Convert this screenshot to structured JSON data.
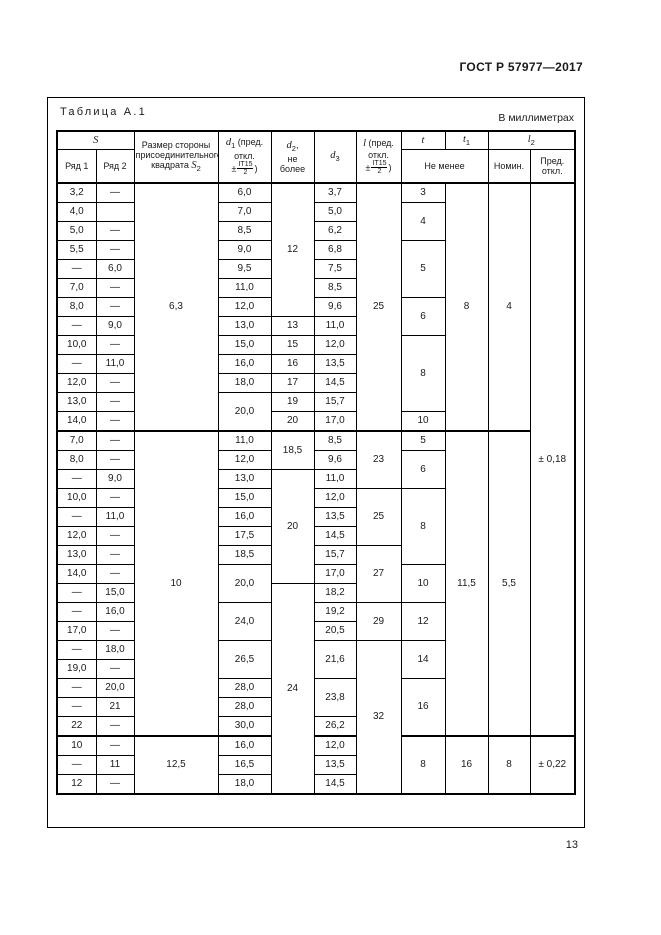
{
  "doc": {
    "standard_number": "ГОСТ Р 57977—2017",
    "page_number": "13"
  },
  "table": {
    "caption": "Таблица А.1",
    "units": "В миллиметрах",
    "header": {
      "s": "S",
      "ryad1": "Ряд 1",
      "ryad2": "Ряд 2",
      "s2": {
        "l1": "Размер стороны",
        "l2": "присоединительного",
        "l3": "квадрата",
        "var": "S",
        "sub": "2"
      },
      "d1": {
        "var": "d",
        "sub": "1",
        "t1": " (пред.",
        "t2": "откл.",
        "pm": "±",
        "num": "IT15",
        "den": "2",
        "close": ")"
      },
      "d2": {
        "var": "d",
        "sub": "2",
        "after": ",",
        "l1": "не",
        "l2": "более"
      },
      "d3": {
        "var": "d",
        "sub": "3"
      },
      "l": {
        "var": "l",
        "t1": " (пред.",
        "t2": "откл.",
        "pm": "±",
        "num": "IT15",
        "den": "2",
        "close": ")"
      },
      "t": {
        "var": "t"
      },
      "t1": {
        "var": "t",
        "sub": "1"
      },
      "l2": {
        "var": "l",
        "sub": "2"
      },
      "ne_menee": "Не менее",
      "nomin": "Номин.",
      "pred": {
        "l1": "Пред.",
        "l2": "откл."
      }
    },
    "section_start_rows": [
      13,
      29
    ],
    "rows": [
      [
        {
          "v": "3,2"
        },
        {
          "v": "—"
        },
        {
          "v": "6,3",
          "rs": 13
        },
        {
          "v": "6,0"
        },
        {
          "v": "12",
          "rs": 7
        },
        {
          "v": "3,7"
        },
        {
          "v": "25",
          "rs": 13
        },
        {
          "v": "3"
        },
        {
          "v": "8",
          "rs": 13
        },
        {
          "v": "4",
          "rs": 13
        },
        {
          "v": "± 0,18",
          "rs": 29
        }
      ],
      [
        {
          "v": "4,0"
        },
        {
          "v": ""
        },
        {
          "v": "7,0"
        },
        {
          "v": "5,0"
        },
        {
          "v": "4",
          "rs": 2
        }
      ],
      [
        {
          "v": "5,0"
        },
        {
          "v": "—"
        },
        {
          "v": "8,5"
        },
        {
          "v": "6,2"
        }
      ],
      [
        {
          "v": "5,5"
        },
        {
          "v": "—"
        },
        {
          "v": "9,0"
        },
        {
          "v": "6,8"
        },
        {
          "v": "5",
          "rs": 3
        }
      ],
      [
        {
          "v": "—"
        },
        {
          "v": "6,0"
        },
        {
          "v": "9,5"
        },
        {
          "v": "7,5"
        }
      ],
      [
        {
          "v": "7,0"
        },
        {
          "v": "—"
        },
        {
          "v": "11,0"
        },
        {
          "v": "8,5"
        }
      ],
      [
        {
          "v": "8,0"
        },
        {
          "v": "—"
        },
        {
          "v": "12,0"
        },
        {
          "v": "9,6"
        },
        {
          "v": "6",
          "rs": 2
        }
      ],
      [
        {
          "v": "—"
        },
        {
          "v": "9,0"
        },
        {
          "v": "13,0"
        },
        {
          "v": "13"
        },
        {
          "v": "11,0"
        }
      ],
      [
        {
          "v": "10,0"
        },
        {
          "v": "—"
        },
        {
          "v": "15,0"
        },
        {
          "v": "15"
        },
        {
          "v": "12,0"
        },
        {
          "v": "8",
          "rs": 4
        }
      ],
      [
        {
          "v": "—"
        },
        {
          "v": "11,0"
        },
        {
          "v": "16,0"
        },
        {
          "v": "16"
        },
        {
          "v": "13,5"
        }
      ],
      [
        {
          "v": "12,0"
        },
        {
          "v": "—"
        },
        {
          "v": "18,0"
        },
        {
          "v": "17"
        },
        {
          "v": "14,5"
        }
      ],
      [
        {
          "v": "13,0"
        },
        {
          "v": "—"
        },
        {
          "v": "20,0",
          "rs": 2
        },
        {
          "v": "19"
        },
        {
          "v": "15,7"
        }
      ],
      [
        {
          "v": "14,0"
        },
        {
          "v": "—"
        },
        {
          "v": "20"
        },
        {
          "v": "17,0"
        },
        {
          "v": "10"
        }
      ],
      [
        {
          "v": "7,0"
        },
        {
          "v": "—"
        },
        {
          "v": "10",
          "rs": 16
        },
        {
          "v": "11,0"
        },
        {
          "v": "18,5",
          "rs": 2
        },
        {
          "v": "8,5"
        },
        {
          "v": "23",
          "rs": 3
        },
        {
          "v": "5"
        },
        {
          "v": "11,5",
          "rs": 16
        },
        {
          "v": "5,5",
          "rs": 16
        }
      ],
      [
        {
          "v": "8,0"
        },
        {
          "v": "—"
        },
        {
          "v": "12,0"
        },
        {
          "v": "9,6"
        },
        {
          "v": "6",
          "rs": 2
        }
      ],
      [
        {
          "v": "—"
        },
        {
          "v": "9,0"
        },
        {
          "v": "13,0"
        },
        {
          "v": "20",
          "rs": 6
        },
        {
          "v": "11,0"
        }
      ],
      [
        {
          "v": "10,0"
        },
        {
          "v": "—"
        },
        {
          "v": "15,0"
        },
        {
          "v": "12,0"
        },
        {
          "v": "25",
          "rs": 3
        },
        {
          "v": "8",
          "rs": 4
        }
      ],
      [
        {
          "v": "—"
        },
        {
          "v": "11,0"
        },
        {
          "v": "16,0"
        },
        {
          "v": "13,5"
        }
      ],
      [
        {
          "v": "12,0"
        },
        {
          "v": "—"
        },
        {
          "v": "17,5"
        },
        {
          "v": "14,5"
        }
      ],
      [
        {
          "v": "13,0"
        },
        {
          "v": "—"
        },
        {
          "v": "18,5"
        },
        {
          "v": "15,7"
        },
        {
          "v": "27",
          "rs": 3
        }
      ],
      [
        {
          "v": "14,0"
        },
        {
          "v": "—"
        },
        {
          "v": "20,0",
          "rs": 2
        },
        {
          "v": "17,0"
        },
        {
          "v": "10",
          "rs": 2
        }
      ],
      [
        {
          "v": "—"
        },
        {
          "v": "15,0"
        },
        {
          "v": "24",
          "rs": 11
        },
        {
          "v": "18,2"
        }
      ],
      [
        {
          "v": "—"
        },
        {
          "v": "16,0"
        },
        {
          "v": "24,0",
          "rs": 2
        },
        {
          "v": "19,2"
        },
        {
          "v": "29",
          "rs": 2
        },
        {
          "v": "12",
          "rs": 2
        }
      ],
      [
        {
          "v": "17,0"
        },
        {
          "v": "—"
        },
        {
          "v": "20,5"
        }
      ],
      [
        {
          "v": "—"
        },
        {
          "v": "18,0"
        },
        {
          "v": "26,5",
          "rs": 2
        },
        {
          "v": "21,6",
          "rs": 2
        },
        {
          "v": "32",
          "rs": 8
        },
        {
          "v": "14",
          "rs": 2
        }
      ],
      [
        {
          "v": "19,0"
        },
        {
          "v": "—"
        }
      ],
      [
        {
          "v": "—"
        },
        {
          "v": "20,0"
        },
        {
          "v": "28,0"
        },
        {
          "v": "23,8",
          "rs": 2
        },
        {
          "v": "16",
          "rs": 3
        }
      ],
      [
        {
          "v": "—"
        },
        {
          "v": "21"
        },
        {
          "v": "28,0"
        }
      ],
      [
        {
          "v": "22"
        },
        {
          "v": "—"
        },
        {
          "v": "30,0"
        },
        {
          "v": "26,2"
        }
      ],
      [
        {
          "v": "10"
        },
        {
          "v": "—"
        },
        {
          "v": "12,5",
          "rs": 3
        },
        {
          "v": "16,0"
        },
        {
          "v": "12,0"
        },
        {
          "v": "8",
          "rs": 3
        },
        {
          "v": "16",
          "rs": 3
        },
        {
          "v": "8",
          "rs": 3
        },
        {
          "v": "± 0,22",
          "rs": 3
        }
      ],
      [
        {
          "v": "—"
        },
        {
          "v": "11"
        },
        {
          "v": "16,5"
        },
        {
          "v": "13,5"
        }
      ],
      [
        {
          "v": "12"
        },
        {
          "v": "—"
        },
        {
          "v": "18,0"
        },
        {
          "v": "14,5"
        }
      ]
    ]
  }
}
